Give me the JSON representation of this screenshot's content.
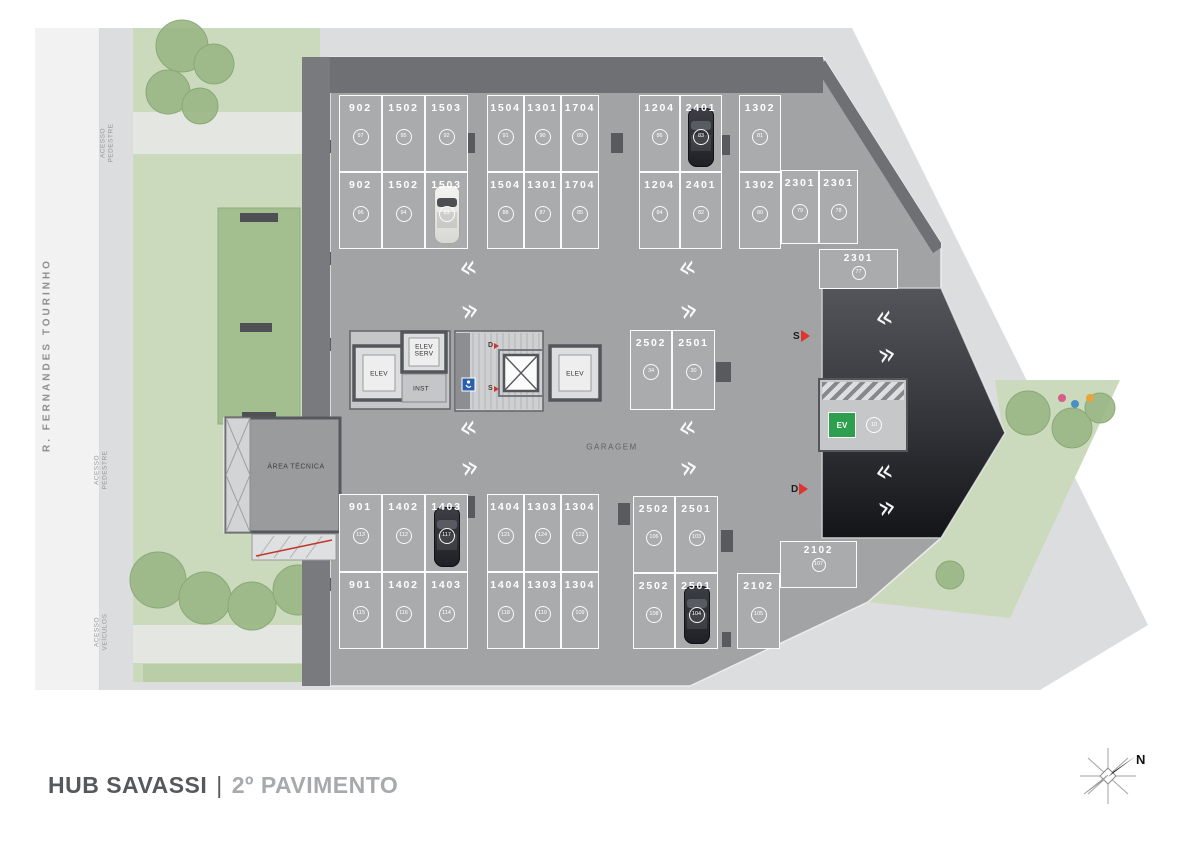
{
  "title": {
    "project": "HUB SAVASSI",
    "divider": "|",
    "floor": "2º PAVIMENTO"
  },
  "street_name": "R. FERNANDES TOURINHO",
  "access_labels": [
    {
      "line1": "ACESSO",
      "line2": "PEDESTRE",
      "x": 108,
      "y": 143
    },
    {
      "line1": "ACESSO",
      "line2": "PEDESTRE",
      "x": 102,
      "y": 470
    },
    {
      "line1": "ACESSO",
      "line2": "VEÍCULOS",
      "x": 102,
      "y": 632
    }
  ],
  "plan_labels": {
    "garage": "GARAGEM",
    "technical_area": "ÁREA TÉCNICA"
  },
  "core": {
    "elev_left": "ELEV",
    "elev_serv": "ELEV\nSERV",
    "inst": "INST",
    "elev_right": "ELEV",
    "stair_down": "D",
    "stair_up": "S"
  },
  "ramp_markers": [
    {
      "letter": "S",
      "x": 793,
      "y": 330
    },
    {
      "letter": "D",
      "x": 791,
      "y": 483
    }
  ],
  "ev_spot": {
    "icon": "EV",
    "badge": "10"
  },
  "compass": {
    "label": "N"
  },
  "aisle_markers": [
    {
      "ch": "«",
      "x": 468,
      "y": 268
    },
    {
      "ch": "»",
      "x": 470,
      "y": 311
    },
    {
      "ch": "«",
      "x": 687,
      "y": 268
    },
    {
      "ch": "»",
      "x": 689,
      "y": 311
    },
    {
      "ch": "«",
      "x": 468,
      "y": 428
    },
    {
      "ch": "»",
      "x": 470,
      "y": 468
    },
    {
      "ch": "«",
      "x": 687,
      "y": 428
    },
    {
      "ch": "»",
      "x": 689,
      "y": 468
    },
    {
      "ch": "«",
      "x": 884,
      "y": 318
    },
    {
      "ch": "»",
      "x": 887,
      "y": 355
    },
    {
      "ch": "«",
      "x": 884,
      "y": 472
    },
    {
      "ch": "»",
      "x": 887,
      "y": 508
    }
  ],
  "parking_spots": [
    {
      "n": "902",
      "b": "97",
      "x": 339,
      "y": 95,
      "w": 43,
      "h": 77
    },
    {
      "n": "1502",
      "b": "95",
      "x": 382,
      "y": 95,
      "w": 43,
      "h": 77
    },
    {
      "n": "1503",
      "b": "92",
      "x": 425,
      "y": 95,
      "w": 43,
      "h": 77
    },
    {
      "n": "1504",
      "b": "91",
      "x": 487,
      "y": 95,
      "w": 37,
      "h": 77
    },
    {
      "n": "1301",
      "b": "90",
      "x": 524,
      "y": 95,
      "w": 37,
      "h": 77
    },
    {
      "n": "1704",
      "b": "89",
      "x": 561,
      "y": 95,
      "w": 38,
      "h": 77
    },
    {
      "n": "1204",
      "b": "86",
      "x": 639,
      "y": 95,
      "w": 41,
      "h": 77
    },
    {
      "n": "2401",
      "b": "83",
      "x": 680,
      "y": 95,
      "w": 42,
      "h": 77,
      "car": "dark"
    },
    {
      "n": "1302",
      "b": "81",
      "x": 739,
      "y": 95,
      "w": 42,
      "h": 77
    },
    {
      "n": "902",
      "b": "96",
      "x": 339,
      "y": 172,
      "w": 43,
      "h": 77
    },
    {
      "n": "1502",
      "b": "94",
      "x": 382,
      "y": 172,
      "w": 43,
      "h": 77
    },
    {
      "n": "1503",
      "b": "93",
      "x": 425,
      "y": 172,
      "w": 43,
      "h": 77,
      "car": "white"
    },
    {
      "n": "1504",
      "b": "88",
      "x": 487,
      "y": 172,
      "w": 37,
      "h": 77
    },
    {
      "n": "1301",
      "b": "87",
      "x": 524,
      "y": 172,
      "w": 37,
      "h": 77
    },
    {
      "n": "1704",
      "b": "85",
      "x": 561,
      "y": 172,
      "w": 38,
      "h": 77
    },
    {
      "n": "1204",
      "b": "84",
      "x": 639,
      "y": 172,
      "w": 41,
      "h": 77
    },
    {
      "n": "2401",
      "b": "82",
      "x": 680,
      "y": 172,
      "w": 42,
      "h": 77
    },
    {
      "n": "1302",
      "b": "80",
      "x": 739,
      "y": 172,
      "w": 42,
      "h": 77
    },
    {
      "n": "2301",
      "b": "79",
      "x": 781,
      "y": 170,
      "w": 38,
      "h": 74
    },
    {
      "n": "2301",
      "b": "78",
      "x": 819,
      "y": 170,
      "w": 39,
      "h": 74
    },
    {
      "n": "2301",
      "b": "77",
      "x": 819,
      "y": 249,
      "w": 79,
      "h": 40
    },
    {
      "n": "2502",
      "b": "34",
      "x": 630,
      "y": 330,
      "w": 42,
      "h": 80
    },
    {
      "n": "2501",
      "b": "30",
      "x": 672,
      "y": 330,
      "w": 43,
      "h": 80
    },
    {
      "n": "901",
      "b": "113",
      "x": 339,
      "y": 494,
      "w": 43,
      "h": 78
    },
    {
      "n": "1402",
      "b": "112",
      "x": 382,
      "y": 494,
      "w": 43,
      "h": 78
    },
    {
      "n": "1403",
      "b": "117",
      "x": 425,
      "y": 494,
      "w": 43,
      "h": 78,
      "car": "dark"
    },
    {
      "n": "1404",
      "b": "121",
      "x": 487,
      "y": 494,
      "w": 37,
      "h": 78
    },
    {
      "n": "1303",
      "b": "124",
      "x": 524,
      "y": 494,
      "w": 37,
      "h": 78
    },
    {
      "n": "1304",
      "b": "123",
      "x": 561,
      "y": 494,
      "w": 38,
      "h": 78
    },
    {
      "n": "901",
      "b": "115",
      "x": 339,
      "y": 572,
      "w": 43,
      "h": 77
    },
    {
      "n": "1402",
      "b": "116",
      "x": 382,
      "y": 572,
      "w": 43,
      "h": 77
    },
    {
      "n": "1403",
      "b": "114",
      "x": 425,
      "y": 572,
      "w": 43,
      "h": 77
    },
    {
      "n": "1404",
      "b": "118",
      "x": 487,
      "y": 572,
      "w": 37,
      "h": 77
    },
    {
      "n": "1303",
      "b": "110",
      "x": 524,
      "y": 572,
      "w": 37,
      "h": 77
    },
    {
      "n": "1304",
      "b": "109",
      "x": 561,
      "y": 572,
      "w": 38,
      "h": 77
    },
    {
      "n": "2502",
      "b": "106",
      "x": 633,
      "y": 496,
      "w": 42,
      "h": 77
    },
    {
      "n": "2501",
      "b": "103",
      "x": 675,
      "y": 496,
      "w": 43,
      "h": 77
    },
    {
      "n": "2502",
      "b": "108",
      "x": 633,
      "y": 573,
      "w": 42,
      "h": 76
    },
    {
      "n": "2501",
      "b": "104",
      "x": 675,
      "y": 573,
      "w": 43,
      "h": 76,
      "car": "dark"
    },
    {
      "n": "2102",
      "b": "105",
      "x": 737,
      "y": 573,
      "w": 43,
      "h": 76
    },
    {
      "n": "2102",
      "b": "107",
      "x": 780,
      "y": 541,
      "w": 77,
      "h": 47
    }
  ]
}
